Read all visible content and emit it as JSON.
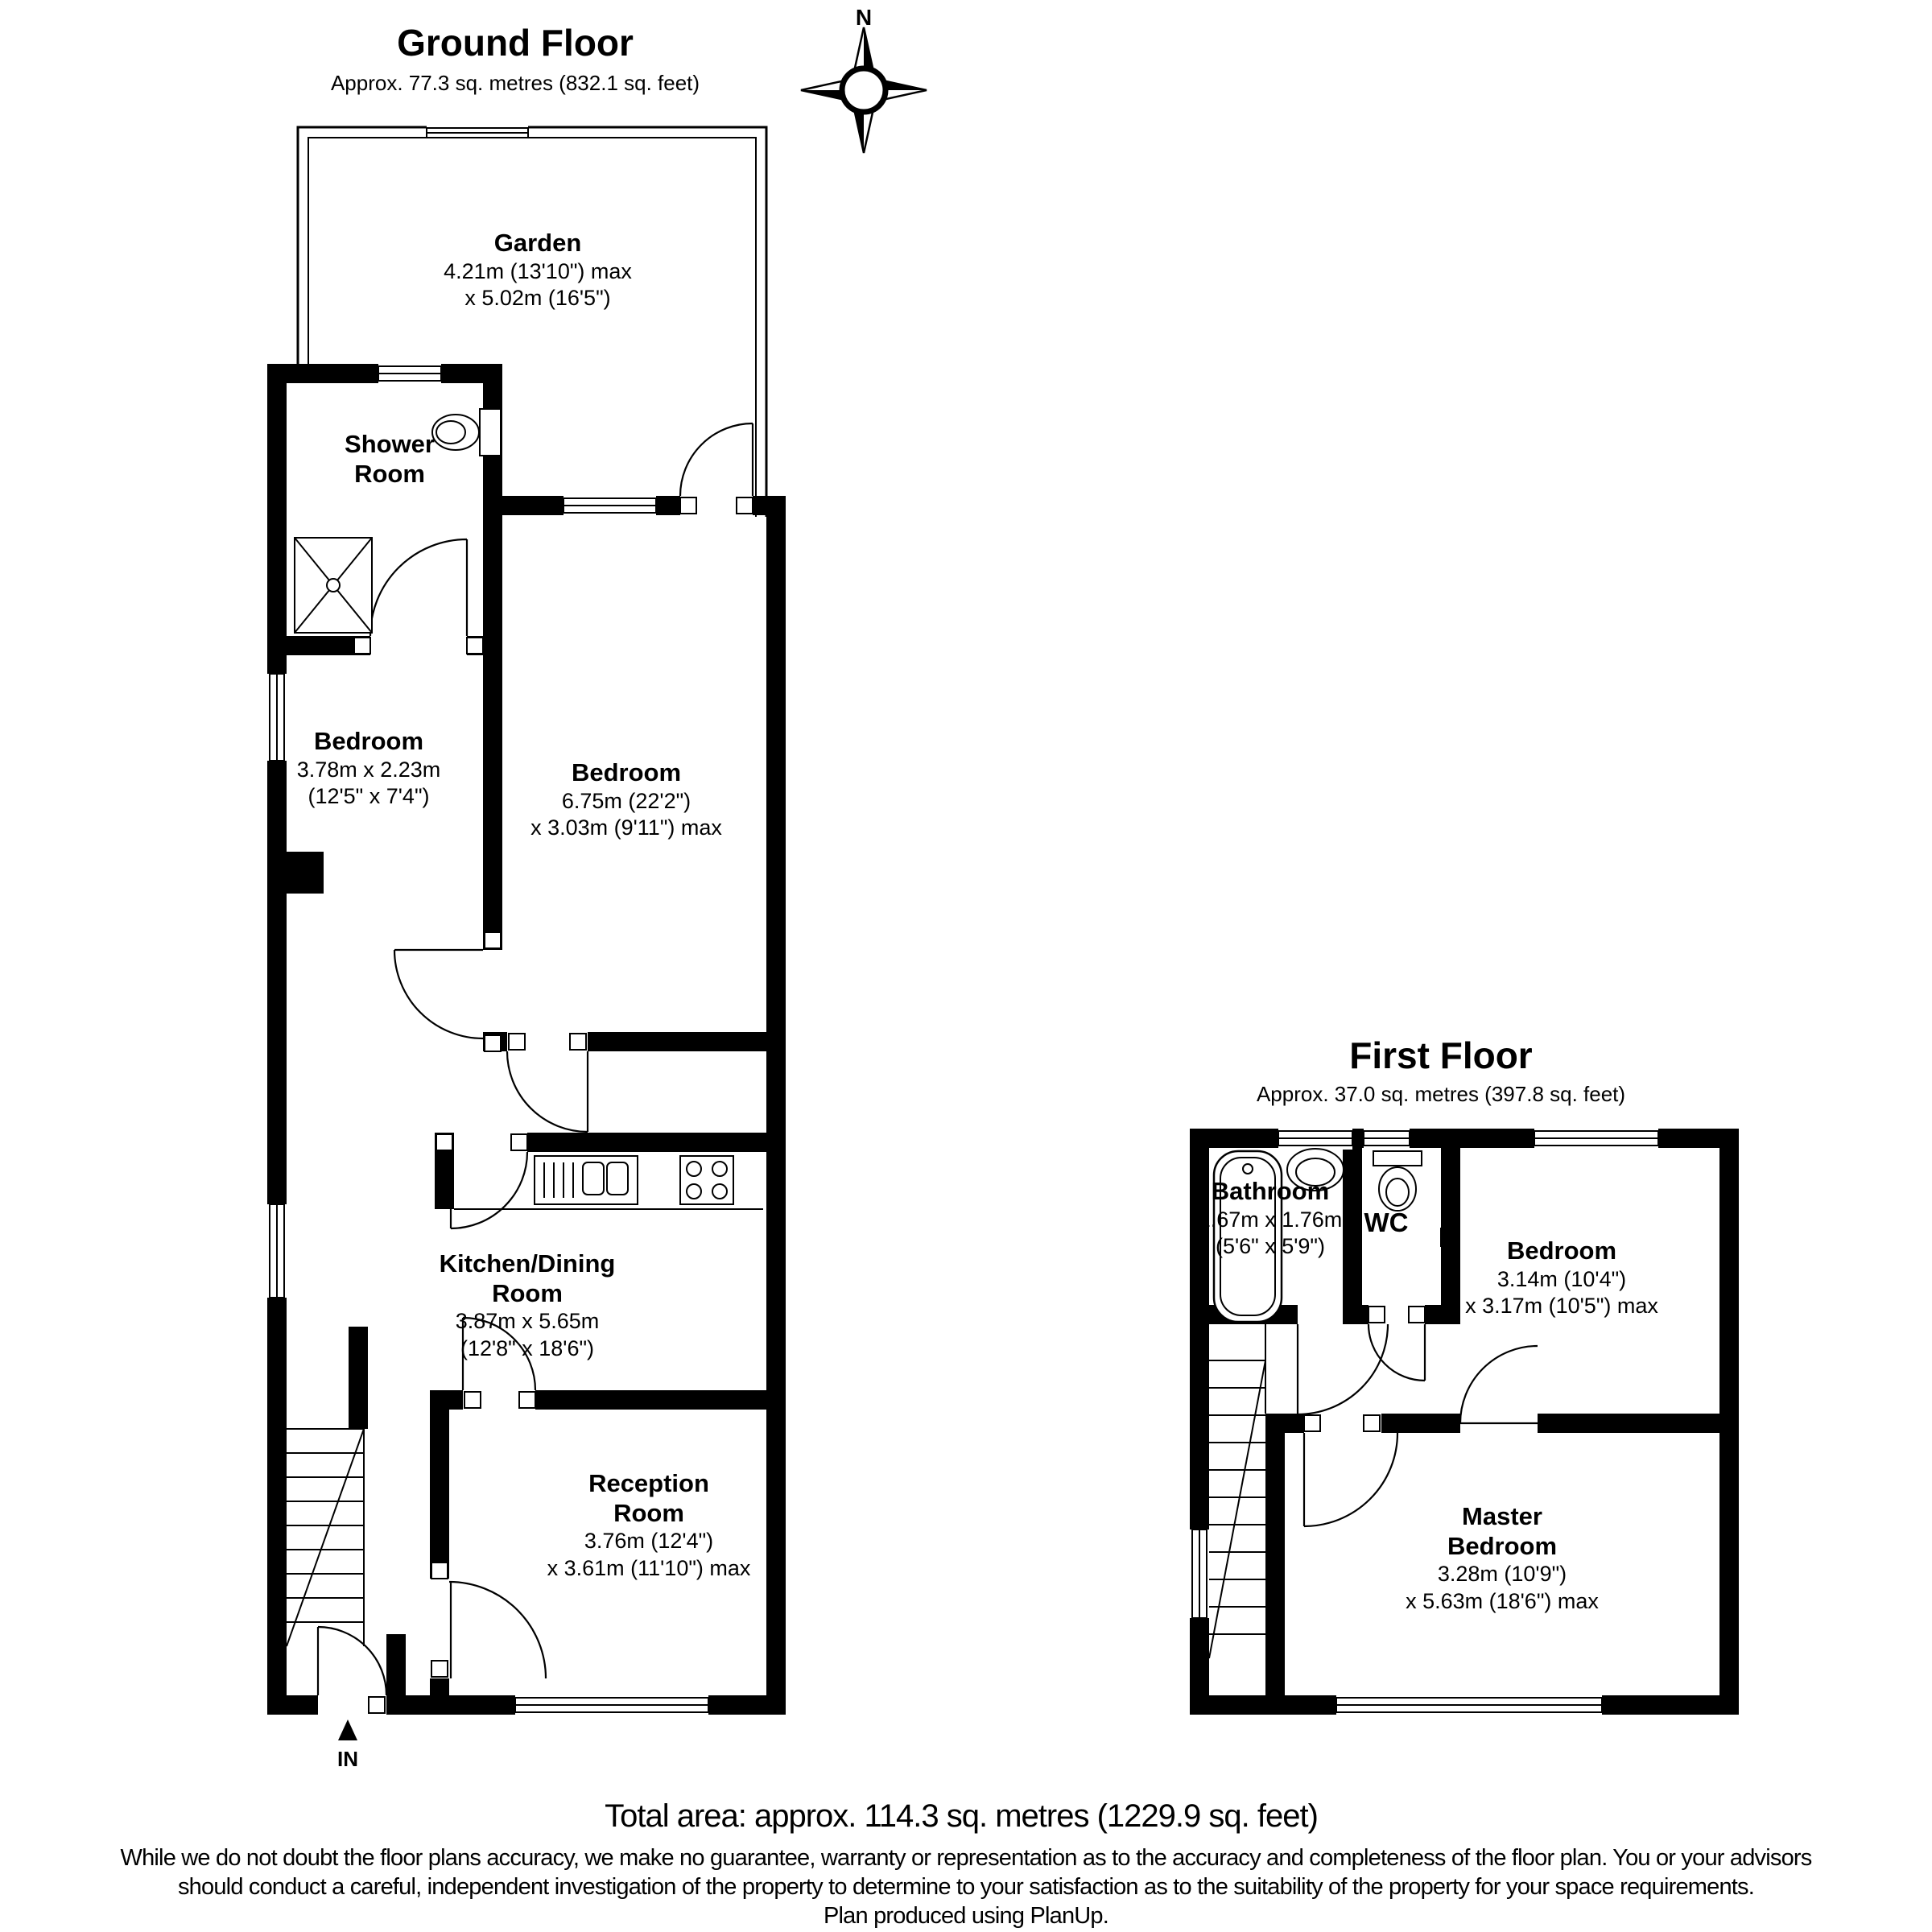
{
  "colors": {
    "wall": "#000000",
    "line": "#000000",
    "background": "#ffffff",
    "text": "#000000"
  },
  "compass": {
    "north_label": "N"
  },
  "ground_floor": {
    "title": "Ground Floor",
    "subtitle": "Approx. 77.3 sq. metres (832.1 sq. feet)",
    "entrance_label": "IN",
    "rooms": {
      "garden": {
        "name": "Garden",
        "dim1": "4.21m (13'10\") max",
        "dim2": "x 5.02m (16'5\")"
      },
      "shower_room": {
        "name": "Shower Room"
      },
      "bedroom_left": {
        "name": "Bedroom",
        "dim1": "3.78m x 2.23m",
        "dim2": "(12'5\" x 7'4\")"
      },
      "bedroom_main": {
        "name": "Bedroom",
        "dim1": "6.75m (22'2\")",
        "dim2": "x 3.03m (9'11\") max"
      },
      "kitchen_dining": {
        "name": "Kitchen/Dining Room",
        "dim1": "3.87m x 5.65m",
        "dim2": "(12'8\" x 18'6\")"
      },
      "reception": {
        "name": "Reception Room",
        "dim1": "3.76m (12'4\")",
        "dim2": "x 3.61m (11'10\") max"
      }
    }
  },
  "first_floor": {
    "title": "First Floor",
    "subtitle": "Approx. 37.0 sq. metres (397.8 sq. feet)",
    "rooms": {
      "bathroom": {
        "name": "Bathroom",
        "dim1": "1.67m x 1.76m",
        "dim2": "(5'6\" x 5'9\")"
      },
      "wc": {
        "name": "WC"
      },
      "bedroom": {
        "name": "Bedroom",
        "dim1": "3.14m (10'4\")",
        "dim2": "x 3.17m (10'5\") max"
      },
      "master_bedroom": {
        "name": "Master Bedroom",
        "dim1": "3.28m (10'9\")",
        "dim2": "x 5.63m (18'6\") max"
      }
    }
  },
  "footer": {
    "total_area": "Total area: approx. 114.3 sq. metres (1229.9 sq. feet)",
    "disclaimer_line1": "While we do not doubt the floor plans accuracy, we make no guarantee, warranty or representation as to the accuracy and completeness of the floor plan. You or your advisors",
    "disclaimer_line2": "should conduct a careful, independent investigation of the property to determine to your satisfaction as to the suitability of the property for your space requirements.",
    "disclaimer_line3": "Plan produced using PlanUp."
  }
}
